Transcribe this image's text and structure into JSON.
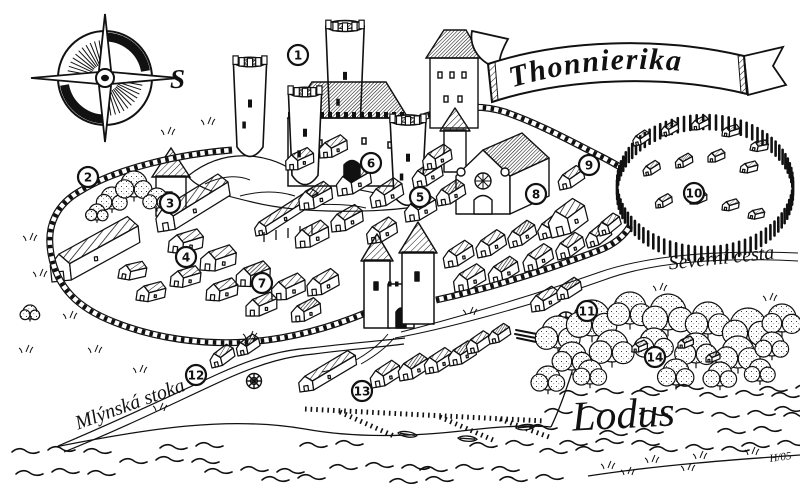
{
  "map": {
    "title": "Thonnierika",
    "compass": {
      "label": "S"
    },
    "signature": "H/05",
    "ink_color": "#111111",
    "paper_color": "#ffffff",
    "labels": [
      {
        "id": "severni-cesta",
        "text": "Severní cesta",
        "x": 722,
        "y": 264,
        "rotate": -6,
        "size": 20
      },
      {
        "id": "mlynska-stoka",
        "text": "Mlýnská stoka",
        "x": 132,
        "y": 410,
        "rotate": -20,
        "size": 20
      },
      {
        "id": "river-lodus",
        "text": "Lodus",
        "x": 624,
        "y": 428,
        "rotate": -3,
        "size": 42
      }
    ],
    "markers": [
      {
        "n": "1",
        "x": 298,
        "y": 55
      },
      {
        "n": "2",
        "x": 88,
        "y": 177
      },
      {
        "n": "3",
        "x": 170,
        "y": 203
      },
      {
        "n": "4",
        "x": 186,
        "y": 257
      },
      {
        "n": "5",
        "x": 420,
        "y": 197
      },
      {
        "n": "6",
        "x": 371,
        "y": 163
      },
      {
        "n": "7",
        "x": 262,
        "y": 283
      },
      {
        "n": "8",
        "x": 536,
        "y": 194
      },
      {
        "n": "9",
        "x": 589,
        "y": 165
      },
      {
        "n": "10",
        "x": 694,
        "y": 193
      },
      {
        "n": "11",
        "x": 587,
        "y": 311
      },
      {
        "n": "12",
        "x": 196,
        "y": 375
      },
      {
        "n": "13",
        "x": 362,
        "y": 391
      },
      {
        "n": "14",
        "x": 655,
        "y": 357
      }
    ]
  }
}
